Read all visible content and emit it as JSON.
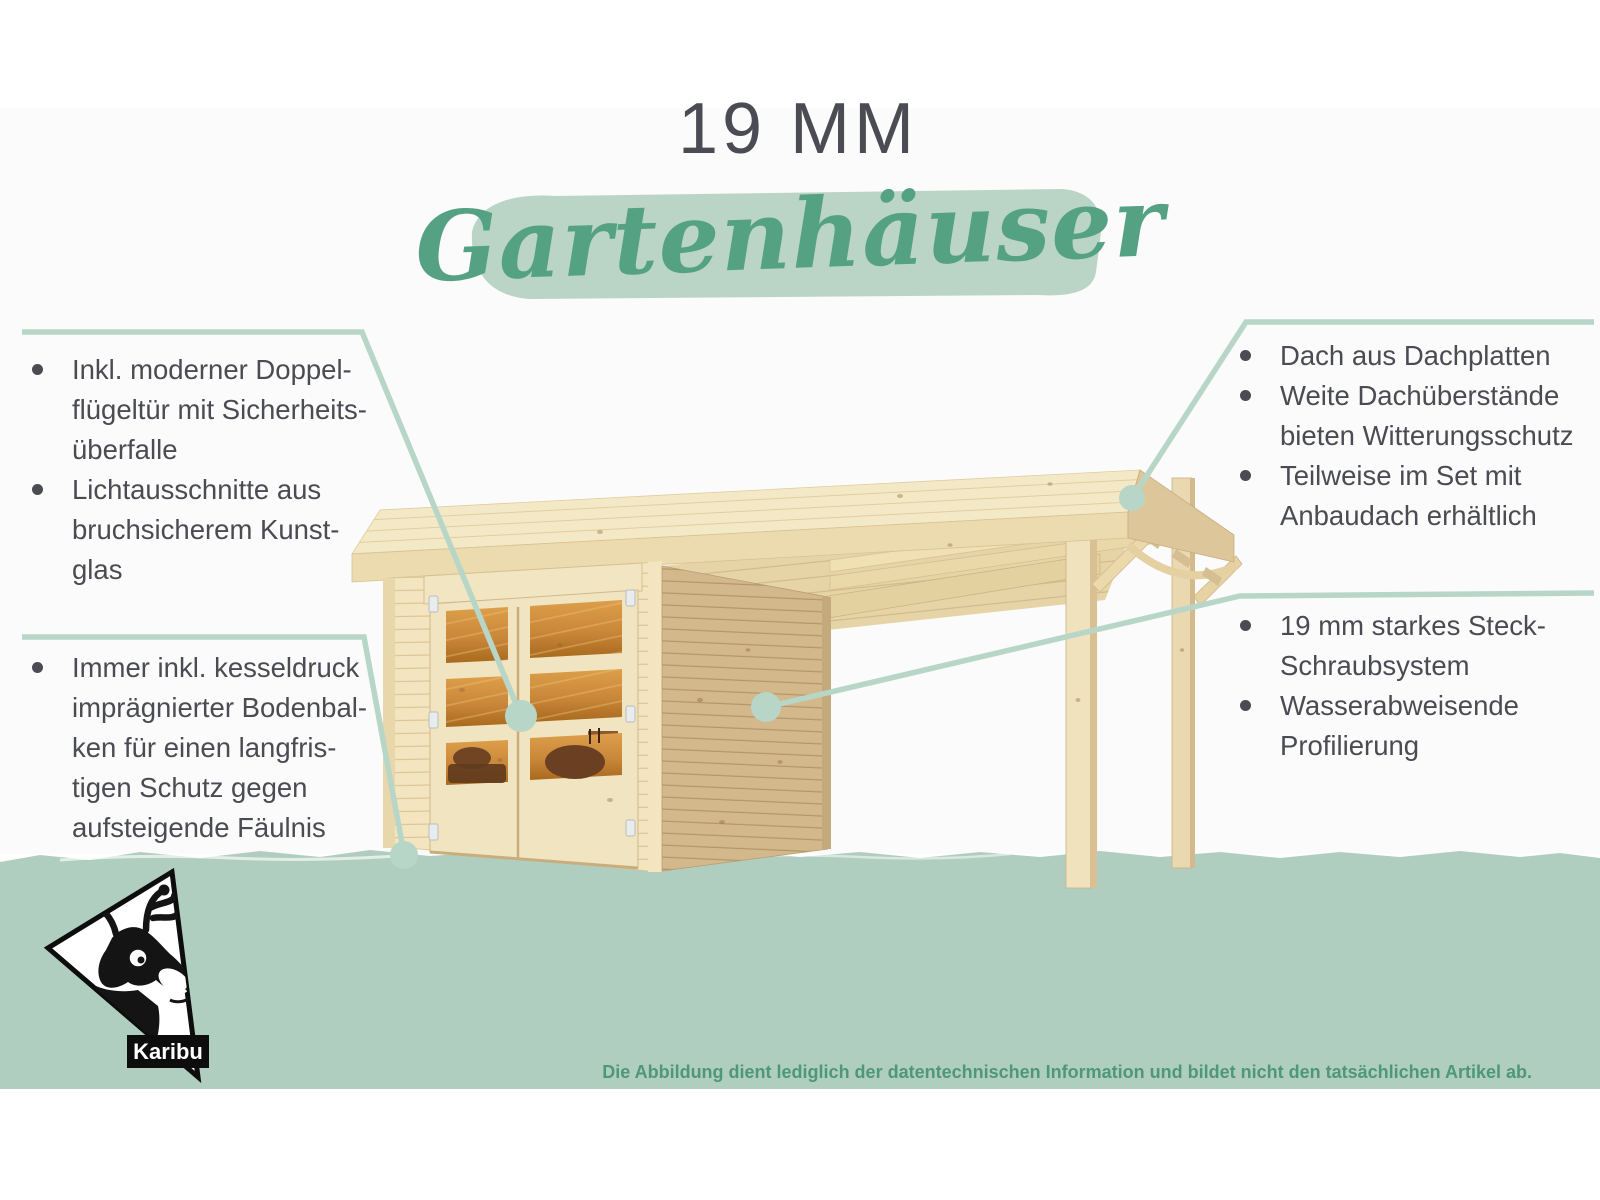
{
  "title": {
    "kicker": "19 MM",
    "script": "Gartenhäuser"
  },
  "callouts": {
    "left_top": {
      "items": [
        {
          "lines": [
            "Inkl. moderner Doppel-",
            "flügeltür mit Sicherheits-",
            "überfalle"
          ]
        },
        {
          "lines": [
            "Lichtausschnitte aus",
            "bruchsicherem Kunst-",
            "glas"
          ]
        }
      ]
    },
    "left_bottom": {
      "items": [
        {
          "lines": [
            "Immer inkl. kesseldruck",
            "imprägnierter Bodenbal-",
            "ken für einen langfris-",
            "tigen Schutz gegen",
            "aufsteigende Fäulnis"
          ]
        }
      ]
    },
    "right_top": {
      "items": [
        {
          "lines": [
            "Dach aus Dachplatten"
          ]
        },
        {
          "lines": [
            "Weite Dachüberstände",
            "bieten Witterungsschutz"
          ]
        },
        {
          "lines": [
            "Teilweise im Set mit",
            "Anbaudach erhältlich"
          ]
        }
      ]
    },
    "right_mid": {
      "items": [
        {
          "lines": [
            "19 mm starkes Steck-",
            "Schraubsystem"
          ]
        },
        {
          "lines": [
            "Wasserabweisende",
            "Profilierung"
          ]
        }
      ]
    }
  },
  "logo": {
    "brand": "Karibu"
  },
  "footer": {
    "disclaimer": "Die Abbildung dient lediglich der datentechnischen Information und bildet nicht den tatsächlichen Artikel ab."
  },
  "colors": {
    "band": "#b0cec0",
    "accent_line": "#b7d6c7",
    "brush": "#bad4c6",
    "text": "#4b4b53",
    "script_green": "#55a184",
    "disclaimer_green": "#4e9779",
    "wood_light": "#f2e5bf",
    "wood_side": "#d2b88b",
    "glass_amber": "#c9873a"
  }
}
